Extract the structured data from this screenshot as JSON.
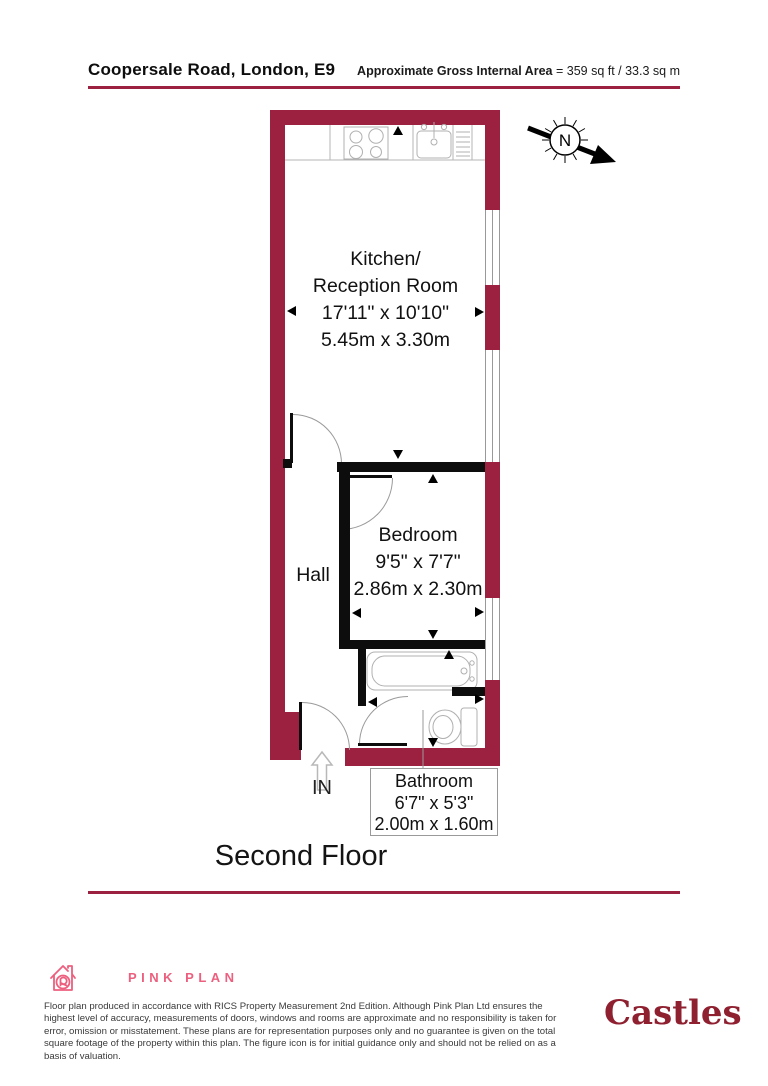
{
  "header": {
    "address": "Coopersale Road, London, E9",
    "area_label": "Approximate Gross Internal Area",
    "area_value": "= 359 sq ft / 33.3 sq m"
  },
  "plan": {
    "compass_label": "N",
    "entrance_label": "IN",
    "floor_label": "Second Floor",
    "rooms": {
      "kitchen": {
        "name_line1": "Kitchen/",
        "name_line2": "Reception Room",
        "size_imperial": "17'11\" x 10'10\"",
        "size_metric": "5.45m x 3.30m"
      },
      "bedroom": {
        "name": "Bedroom",
        "size_imperial": "9'5\" x 7'7\"",
        "size_metric": "2.86m x 2.30m"
      },
      "hall": {
        "name": "Hall"
      },
      "bathroom": {
        "name": "Bathroom",
        "size_imperial": "6'7\" x 5'3\"",
        "size_metric": "2.00m x 1.60m"
      }
    }
  },
  "footer": {
    "producer_name": "PINK PLAN",
    "disclaimer": "Floor plan produced in accordance with RICS Property Measurement 2nd Edition. Although Pink Plan Ltd ensures the highest level of accuracy, measurements of doors, windows and rooms are approximate and no responsibility is taken for error, omission or misstatement. These plans are for representation purposes only and no guarantee is given on the total square footage of the property within this plan. The figure icon is for initial guidance only and should not be relied on as a basis of valuation.",
    "agency_name": "Castles"
  },
  "colors": {
    "wall_maroon": "#9c2140",
    "pinkplan_pink": "#ed5f7e",
    "castles_red": "#8e2030"
  }
}
